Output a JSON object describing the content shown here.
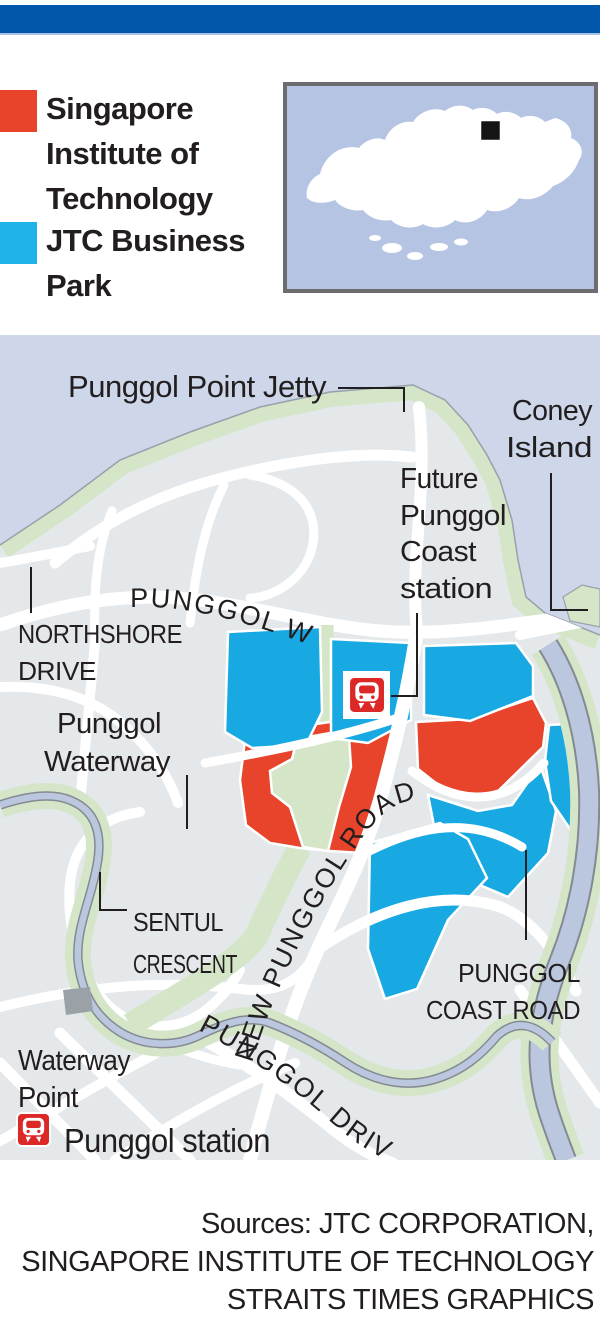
{
  "header": {
    "bar_color": "#0057ab"
  },
  "legend": {
    "sit": {
      "color": "#e8432b",
      "lines": [
        "Singapore",
        "Institute of",
        "Technology"
      ]
    },
    "jtc": {
      "color": "#1fb4e9",
      "lines": [
        "JTC Business",
        "Park"
      ]
    }
  },
  "inset": {
    "name": "Singapore locator map",
    "marker": "black-square-marker"
  },
  "map": {
    "labels": {
      "jetty": "Punggol Point Jetty",
      "coney": [
        "Coney",
        "Island"
      ],
      "future_station": [
        "Future",
        "Punggol",
        "Coast",
        "station"
      ],
      "northshore": [
        "NORTHSHORE",
        "DRIVE"
      ],
      "waterway": [
        "Punggol",
        "Waterway"
      ],
      "sentul": [
        "SENTUL",
        "CRESCENT"
      ],
      "waterway_point": [
        "Waterway",
        "Point"
      ],
      "coast_road": [
        "PUNGGOL",
        "COAST ROAD"
      ],
      "station_legend": "Punggol station"
    },
    "road_labels": {
      "punggol_way": "PUNGGOL WAY",
      "new_punggol_road": "NEW PUNGGOL ROAD",
      "punggol_drive": "PUNGGOL DRIVE"
    },
    "colors": {
      "sea": "#cdd7e9",
      "land": "#e4e8ea",
      "park_green": "#d4e5c8",
      "road": "#ffffff",
      "sit_parcel": "#e8432b",
      "jtc_parcel": "#18a9e2",
      "mrt_red": "#dc2826",
      "water_ribbon": "#bac7df"
    }
  },
  "sources": {
    "lines": [
      "Sources: JTC CORPORATION,",
      "SINGAPORE INSTITUTE OF TECHNOLOGY",
      "STRAITS TIMES GRAPHICS"
    ]
  }
}
